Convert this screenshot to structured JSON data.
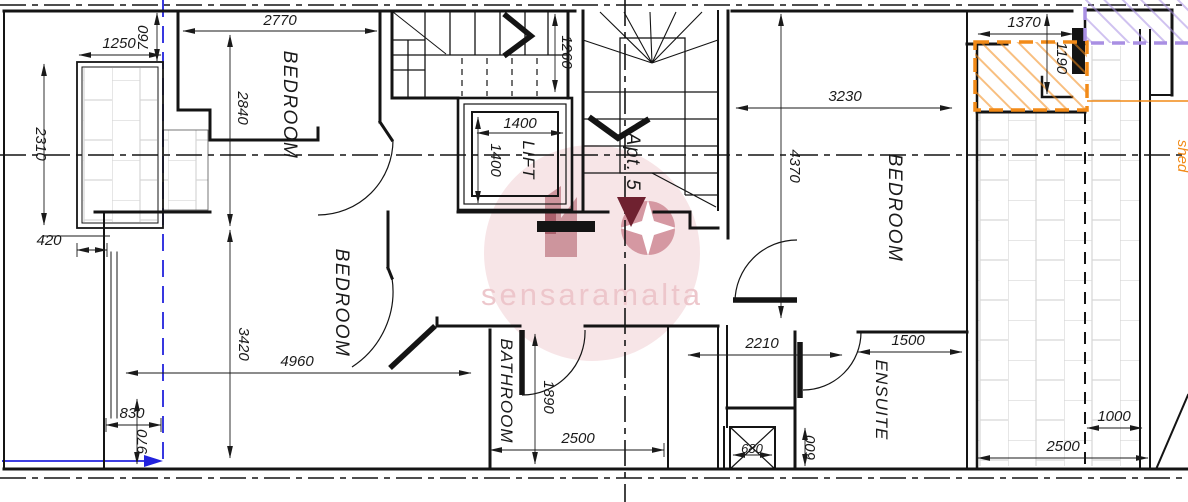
{
  "drawing": {
    "watermark": "sensaramalta",
    "apartment": "Apt. 5",
    "rooms": {
      "bedroom_top_left": "BEDROOM",
      "bedroom_bottom_left": "BEDROOM",
      "bedroom_right": "BEDROOM",
      "bathroom": "BATHROOM",
      "ensuite": "ENSUITE",
      "lift": "LIFT",
      "shed": "shed"
    },
    "dimensions": {
      "d2770": "2770",
      "d2840": "2840",
      "d1250": "1250",
      "d760": "760",
      "d2310": "2310",
      "d420": "420",
      "d1260": "1260",
      "d1400w": "1400",
      "d1400h": "1400",
      "d3230": "3230",
      "d4370": "4370",
      "d1370": "1370",
      "d1190": "1190",
      "d3420": "3420",
      "d4960": "4960",
      "d830": "830",
      "d970": "970",
      "d1890": "1890",
      "d2500a": "2500",
      "d2210": "2210",
      "d1500": "1500",
      "d680": "680",
      "d600": "600",
      "d1000": "1000",
      "d2500b": "2500"
    },
    "colors": {
      "wall": "#141414",
      "blue": "#2222dd",
      "orange": "#f28a17",
      "purple": "#a98fe3",
      "maroon": "#6f2130",
      "brick": "#d6d6d6",
      "watermark_pink": "#f6e3e5",
      "watermark_text": "#edc5ca"
    }
  }
}
